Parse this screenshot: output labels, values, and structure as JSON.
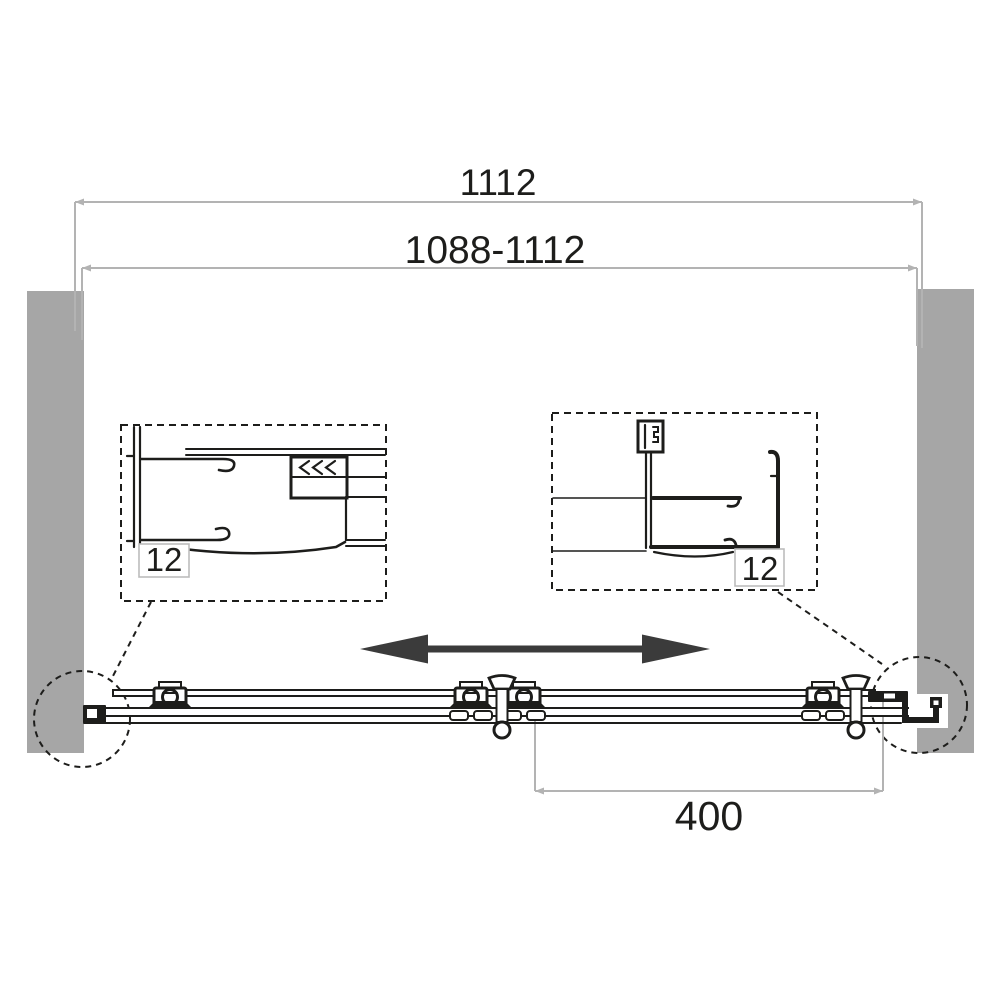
{
  "drawing": {
    "type": "sliding-door-installation-diagram",
    "labels": {
      "overall_width": "1112",
      "adjustment_range": "1088-1112",
      "detail_left_adjustment": "12",
      "detail_right_adjustment": "12",
      "door_travel_width": "400"
    },
    "colors": {
      "line": "#1d1d1b",
      "dim_line": "#b3b3b3",
      "wall_fill": "#a6a6a6",
      "arrow_fill": "#3b3b3b",
      "label_box_border": "#bcbcbc",
      "text": "#1d1d1b",
      "background": "#ffffff"
    }
  }
}
